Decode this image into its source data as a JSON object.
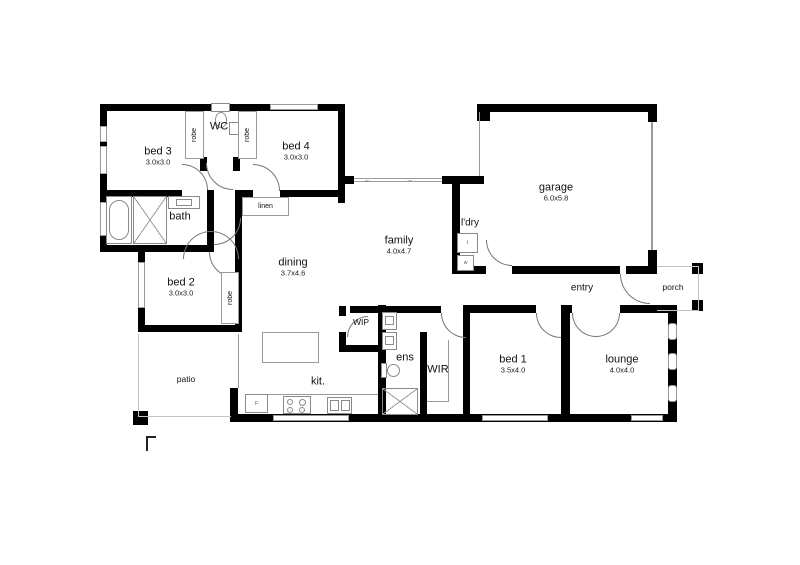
{
  "plan": {
    "rooms": {
      "bed3": {
        "label": "bed 3",
        "dims": "3.0x3.0"
      },
      "wc": {
        "label": "WC"
      },
      "bed4": {
        "label": "bed 4",
        "dims": "3.0x3.0"
      },
      "garage": {
        "label": "garage",
        "dims": "6.0x5.8"
      },
      "bath": {
        "label": "bath"
      },
      "linen": {
        "label": "linen"
      },
      "ldry": {
        "label": "l'dry"
      },
      "family": {
        "label": "family",
        "dims": "4.0x4.7"
      },
      "dining": {
        "label": "dining",
        "dims": "3.7x4.6"
      },
      "bed2": {
        "label": "bed 2",
        "dims": "3.0x3.0"
      },
      "entry": {
        "label": "entry"
      },
      "porch": {
        "label": "porch"
      },
      "patio": {
        "label": "patio"
      },
      "wip": {
        "label": "WIP"
      },
      "ens": {
        "label": "ens"
      },
      "wir": {
        "label": "WIR"
      },
      "bed1": {
        "label": "bed 1",
        "dims": "3.5x4.0"
      },
      "lounge": {
        "label": "lounge",
        "dims": "4.0x4.0"
      },
      "kit": {
        "label": "kit."
      }
    },
    "closet_label": "robe",
    "marks": {
      "fridge": "F",
      "laundry_trough": "t",
      "laundry_washer": "w",
      "slider_left": "←",
      "slider_right": "→"
    },
    "colors": {
      "wall": "#000000",
      "fixture_line": "#8a8a8a",
      "outdoor_line": "#c3c3c3"
    }
  }
}
